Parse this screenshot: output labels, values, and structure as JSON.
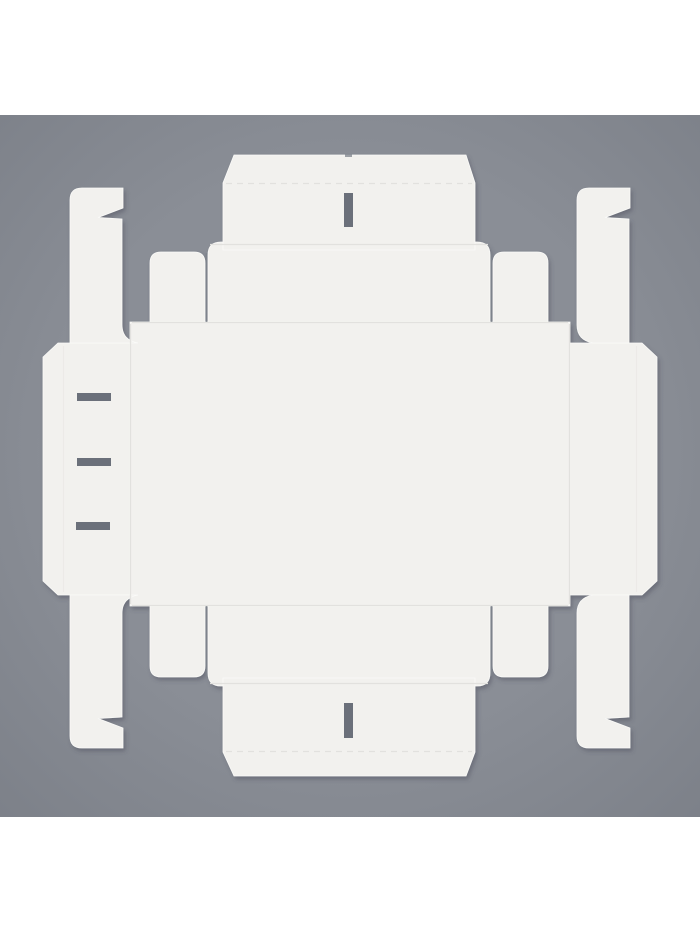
{
  "scene": {
    "type": "product-photo",
    "subject": "white cardboard folding box blank (die-cut dieline) unfolded flat",
    "backdrop": "plain gray studio background",
    "view": "top-down flat lay",
    "letterboxed": "white bars above and below square photo"
  },
  "colors": {
    "letterbox": "#ffffff",
    "bg": "#8a8e96",
    "bg_top_light": "#969aa2",
    "bg_mid": "#8b8f97",
    "bg_dark": "#858993",
    "sheet": "#f2f1ee",
    "sheet_edge": "#fafaf8",
    "crease": "#e2e1de",
    "crease_faint": "#eceae7",
    "cut": "#6b707a",
    "cut_line": "#7e838c",
    "shadow": "#3c4350"
  },
  "photo_frame": {
    "x": "0",
    "y": "115",
    "width": "700",
    "height": "702"
  },
  "dieline": {
    "pieces": {
      "panel": "M130 322 H570 V606 H130 Z",
      "wing_left": "M130 343 H58 L43 357 V581 L58 595 H130 Z",
      "wing_right": "M570 343 H642 L657 357 V581 L642 595 H570 Z",
      "wall_top": "M208 322 V255 Q208 242 221 242 H477 Q490 242 490 255 V322 Z",
      "flap_top": "M223 250 V183 L234 155 H466 L475 183 V250 Z",
      "corner_flap_tl": "M150 322 V263 Q150 252 161 252 H194 Q205 252 205 263 V322 Z",
      "corner_flap_tr": "M493 322 V263 Q493 252 504 252 H537 Q548 252 548 263 V322 Z",
      "wall_bottom": "M208 606 V673 Q208 686 221 686 H477 Q490 686 490 673 V606 Z",
      "flap_bottom": "M223 678 H475 V752 L466 776 H234 L223 752 Z",
      "corner_flap_bl": "M150 606 V666 Q150 677 161 677 H194 Q205 677 205 666 V606 Z",
      "corner_flap_br": "M493 606 V666 Q493 677 504 677 H537 Q548 677 548 666 V606 Z",
      "lock_strip_tl": "M70 343 V200 Q70 188 82 188 H123 V208 L98 217.5 L122 219 V325 Q122 340 138 343 Z",
      "lock_strip_tr": "M577 325 V200 Q577 188 589 188 H630 V208 L605 217.5 L629 219 V343 H593 Q577 340 577 325 Z",
      "lock_strip_bl": "M70 595 V736 Q70 748 82 748 H123 V728 L98 718.5 L122 717 V613 Q122 598 138 595 Z",
      "lock_strip_br": "M577 613 V736 Q577 748 589 748 H630 V728 L605 718.5 L629 717 V595 H593 Q577 598 577 613 Z"
    },
    "cuts": {
      "slot_top": "M344 193 H353 V227 H344 Z",
      "slot_bottom": "M344 703 H353 V738 H344 Z",
      "slit_1": "M77 393 H111 V401 H77 Z",
      "slit_2": "M77 458 H111 V466 H77 Z",
      "slit_3": "M76 522 H110 V530 H76 Z",
      "cutline_tl": "M206.5 254 V321",
      "cutline_tr": "M491.5 254 V321",
      "cutline_bl": "M206.5 607 V675",
      "cutline_br": "M491.5 607 V675",
      "edge_nick": "M345 154 H352 V157 H345 Z"
    },
    "creases": {
      "panel_top": "M132 322.5 H568",
      "panel_bottom": "M132 605.5 H568",
      "panel_left": "M130.5 324 V604",
      "panel_right": "M569.5 324 V604",
      "wall_top_fold": "M210 244.5 H488",
      "wall_bottom_fold": "M210 683.5 H488",
      "lip_top": "M226 183.5 H472",
      "lip_bottom": "M226 751.5 H472",
      "wing_left_fold": "M63.5 346 V592",
      "wing_right_fold": "M636.5 346 V592"
    }
  }
}
